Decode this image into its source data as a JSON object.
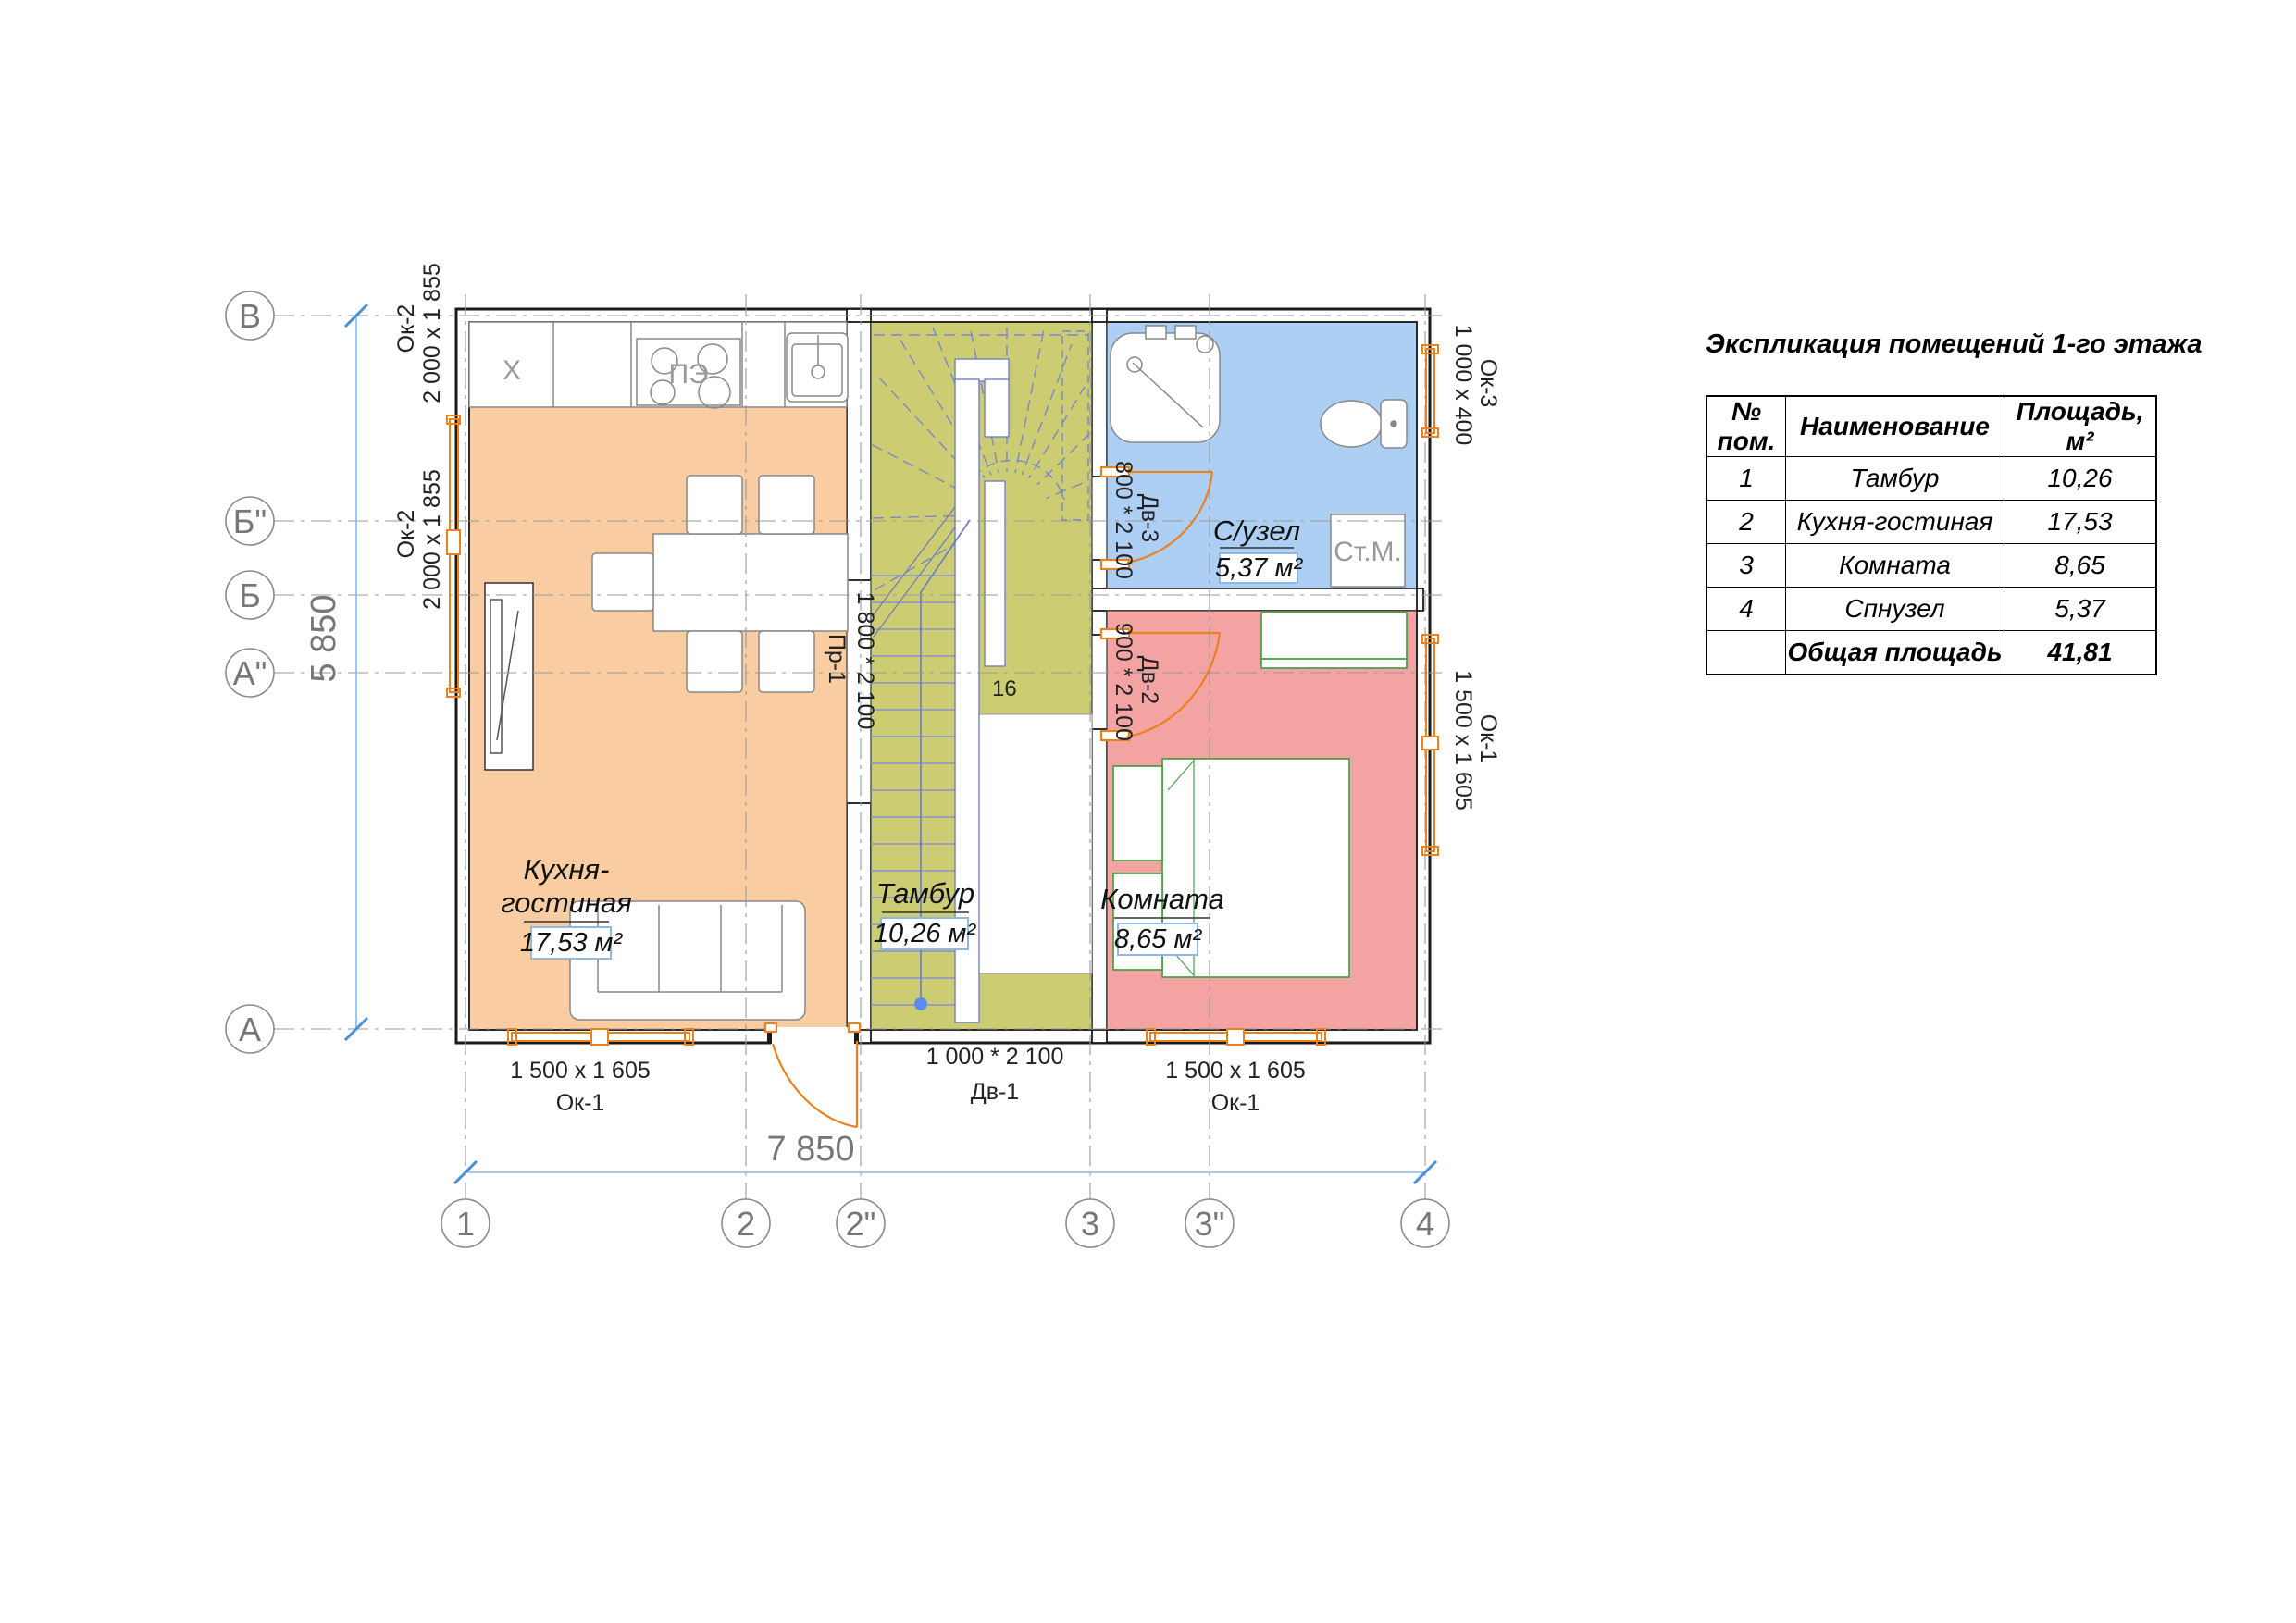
{
  "explication": {
    "title": "Экспликация помещений 1-го этажа",
    "headers": [
      "№ пом.",
      "Наименование",
      "Площадь, м²"
    ],
    "rows": [
      {
        "num": "1",
        "name": "Тамбур",
        "area": "10,26"
      },
      {
        "num": "2",
        "name": "Кухня-гостиная",
        "area": "17,53"
      },
      {
        "num": "3",
        "name": "Комната",
        "area": "8,65"
      },
      {
        "num": "4",
        "name": "Спнузел",
        "area": "5,37"
      }
    ],
    "total": {
      "num": "",
      "name": "Общая площадь",
      "area": "41,81"
    }
  },
  "plan": {
    "rooms": {
      "kitchen": {
        "name1": "Кухня-",
        "name2": "гостиная",
        "area": "17,53 м²"
      },
      "tambour": {
        "name": "Тамбур",
        "area": "10,26 м²"
      },
      "bathroom": {
        "name": "С/узел",
        "area": "5,37 м²"
      },
      "bedroom": {
        "name": "Комната",
        "area": "8,65 м²"
      }
    },
    "grid": {
      "cols": [
        "1",
        "2",
        "2\"",
        "3",
        "3\"",
        "4"
      ],
      "rows": [
        "В",
        "Б\"",
        "Б",
        "А\"",
        "А"
      ]
    },
    "dimensions": {
      "width": "7 850",
      "height": "5 850"
    },
    "windows": {
      "ok1": {
        "label": "Ок-1",
        "size": "1 500 x 1 605"
      },
      "ok2": {
        "label": "Ок-2",
        "size": "2 000 x 1 855"
      },
      "ok3": {
        "label": "Ок-3",
        "size": "1 000 x 400"
      }
    },
    "doors": {
      "dv1": {
        "label": "Дв-1",
        "size": "1 000 * 2 100"
      },
      "dv2": {
        "label": "Дв-2",
        "size": "900 * 2 100"
      },
      "dv3": {
        "label": "Дв-3",
        "size": "800 * 2 100"
      },
      "pr1": {
        "label": "Пр-1",
        "size": "1 800 * 2 100"
      }
    },
    "fixtures": {
      "fridge": "X",
      "stove": "ПЭ",
      "washer": "Ст.М.",
      "stairs_count": "16"
    },
    "colors": {
      "kitchen": "#F9CDA1",
      "tambour": "#CCCC72",
      "bathroom": "#ADCFF3",
      "bedroom": "#F4A3A3",
      "window_door": "#E8821E",
      "dimension_line": "#88B9EA",
      "stairs": "#717FC6",
      "furniture_green": "#44A044"
    }
  }
}
